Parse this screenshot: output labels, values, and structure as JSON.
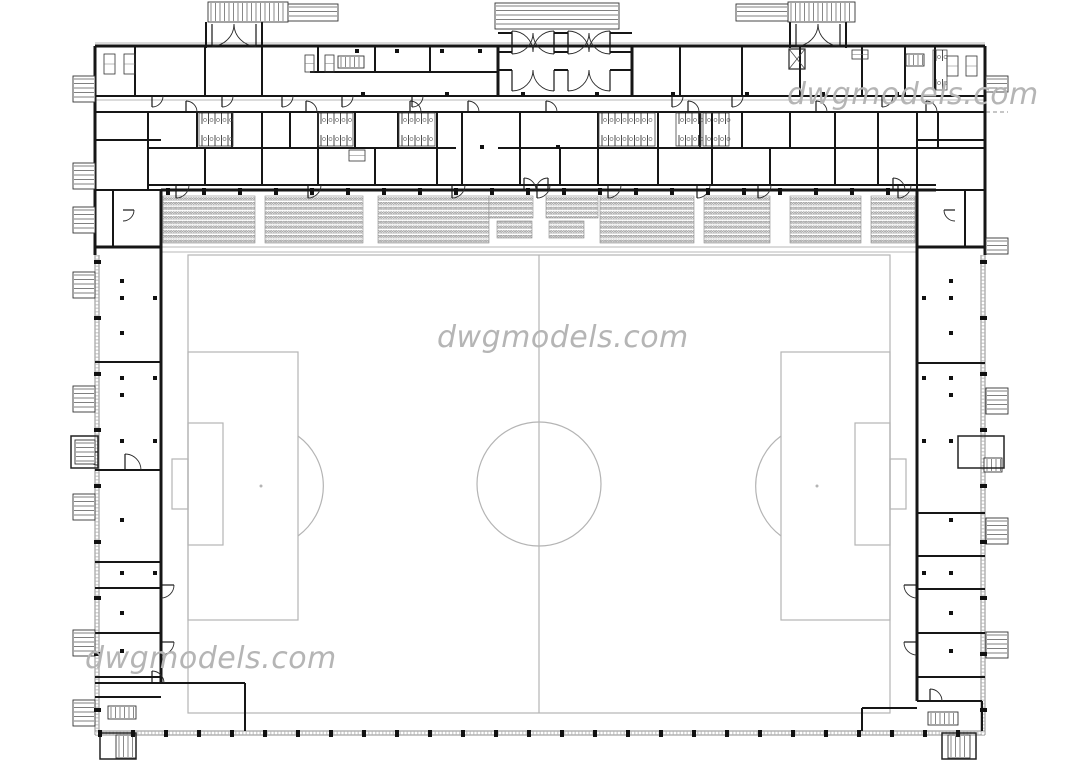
{
  "watermark": {
    "text": "dwgmodels.com",
    "color": "#b5b5b5"
  },
  "plan": {
    "colors": {
      "wall": "#161616",
      "field": "#b4b4b4",
      "light": "#b7b7b7",
      "hatch": "#8c8c8c",
      "seat": "#6f6f6f"
    },
    "canvas": {
      "w": 1080,
      "h": 760
    },
    "field": {
      "boundary": [
        188,
        255,
        702,
        458
      ],
      "center_line_x": 539,
      "center_circle": [
        539,
        484,
        62
      ],
      "penalty_spots": [
        [
          261,
          486
        ],
        [
          817,
          486
        ]
      ],
      "left_penalty_box": [
        188,
        352,
        110,
        268
      ],
      "left_goal_area": [
        188,
        423,
        35,
        122
      ],
      "right_penalty_box": [
        781,
        352,
        109,
        268
      ],
      "right_goal_area": [
        855,
        423,
        35,
        122
      ],
      "left_arc": "M298,436 A62,62 0 0 1 298,536",
      "right_arc": "M781,436 A62,62 0 0 0 781,536",
      "goals": [
        [
          172,
          459,
          16,
          50
        ],
        [
          890,
          459,
          16,
          50
        ]
      ]
    },
    "walls3": [
      [
        95,
        46,
        985,
        46
      ],
      [
        95,
        46,
        95,
        255
      ],
      [
        985,
        46,
        985,
        255
      ],
      [
        161,
        190,
        936,
        190
      ],
      [
        161,
        190,
        161,
        683
      ],
      [
        917,
        190,
        917,
        701
      ],
      [
        95,
        247,
        161,
        247
      ],
      [
        917,
        247,
        985,
        247
      ],
      [
        498,
        45,
        498,
        96
      ],
      [
        632,
        45,
        632,
        96
      ]
    ],
    "walls2": [
      [
        95,
        96,
        985,
        96
      ],
      [
        95,
        112,
        985,
        112
      ],
      [
        148,
        148,
        456,
        148
      ],
      [
        498,
        148,
        985,
        148
      ],
      [
        148,
        185,
        936,
        185
      ],
      [
        95,
        140,
        161,
        140
      ],
      [
        917,
        140,
        985,
        140
      ],
      [
        310,
        72,
        498,
        72
      ],
      [
        95,
        190,
        161,
        190
      ],
      [
        936,
        190,
        985,
        190
      ],
      [
        135,
        45,
        135,
        96
      ],
      [
        205,
        45,
        205,
        96
      ],
      [
        262,
        45,
        262,
        96
      ],
      [
        318,
        45,
        318,
        72
      ],
      [
        375,
        45,
        375,
        72
      ],
      [
        430,
        45,
        430,
        72
      ],
      [
        680,
        45,
        680,
        96
      ],
      [
        742,
        45,
        742,
        96
      ],
      [
        800,
        45,
        800,
        96
      ],
      [
        862,
        45,
        862,
        96
      ],
      [
        905,
        45,
        905,
        96
      ],
      [
        935,
        45,
        935,
        96
      ],
      [
        148,
        112,
        148,
        190
      ],
      [
        197,
        112,
        197,
        148
      ],
      [
        232,
        112,
        232,
        148
      ],
      [
        262,
        112,
        262,
        148
      ],
      [
        290,
        112,
        290,
        148
      ],
      [
        318,
        112,
        318,
        148
      ],
      [
        355,
        112,
        355,
        148
      ],
      [
        398,
        112,
        398,
        148
      ],
      [
        437,
        112,
        437,
        148
      ],
      [
        462,
        112,
        462,
        148
      ],
      [
        520,
        112,
        520,
        148
      ],
      [
        598,
        112,
        598,
        148
      ],
      [
        658,
        112,
        658,
        148
      ],
      [
        700,
        112,
        700,
        148
      ],
      [
        712,
        112,
        712,
        148
      ],
      [
        742,
        112,
        742,
        148
      ],
      [
        790,
        112,
        790,
        148
      ],
      [
        835,
        112,
        835,
        148
      ],
      [
        878,
        112,
        878,
        148
      ],
      [
        917,
        112,
        917,
        190
      ],
      [
        938,
        112,
        938,
        148
      ],
      [
        205,
        148,
        205,
        185
      ],
      [
        262,
        148,
        262,
        185
      ],
      [
        318,
        148,
        318,
        185
      ],
      [
        375,
        148,
        375,
        185
      ],
      [
        437,
        148,
        437,
        185
      ],
      [
        462,
        148,
        462,
        185
      ],
      [
        520,
        148,
        520,
        185
      ],
      [
        560,
        148,
        560,
        185
      ],
      [
        598,
        148,
        598,
        185
      ],
      [
        658,
        148,
        658,
        185
      ],
      [
        712,
        148,
        712,
        185
      ],
      [
        770,
        148,
        770,
        185
      ],
      [
        835,
        148,
        835,
        185
      ],
      [
        878,
        148,
        878,
        185
      ],
      [
        95,
        362,
        161,
        362
      ],
      [
        95,
        470,
        161,
        470
      ],
      [
        95,
        562,
        161,
        562
      ],
      [
        95,
        588,
        161,
        588
      ],
      [
        95,
        633,
        161,
        633
      ],
      [
        95,
        677,
        161,
        677
      ],
      [
        95,
        697,
        161,
        697
      ],
      [
        95,
        683,
        245,
        683
      ],
      [
        245,
        683,
        245,
        731
      ],
      [
        917,
        363,
        985,
        363
      ],
      [
        917,
        513,
        985,
        513
      ],
      [
        917,
        556,
        985,
        556
      ],
      [
        917,
        589,
        985,
        589
      ],
      [
        917,
        633,
        985,
        633
      ],
      [
        917,
        677,
        985,
        677
      ],
      [
        917,
        701,
        982,
        701
      ],
      [
        982,
        701,
        982,
        731
      ],
      [
        862,
        708,
        917,
        708
      ],
      [
        862,
        708,
        862,
        731
      ],
      [
        113,
        190,
        113,
        247
      ],
      [
        965,
        190,
        965,
        247
      ],
      [
        498,
        33,
        512,
        33
      ],
      [
        554,
        33,
        568,
        33
      ],
      [
        610,
        33,
        632,
        33
      ],
      [
        498,
        52,
        512,
        52
      ],
      [
        554,
        52,
        568,
        52
      ],
      [
        610,
        52,
        632,
        52
      ],
      [
        498,
        70,
        512,
        70
      ],
      [
        554,
        70,
        568,
        70
      ],
      [
        610,
        70,
        632,
        70
      ],
      [
        206,
        22,
        206,
        48
      ],
      [
        262,
        22,
        262,
        48
      ],
      [
        790,
        22,
        790,
        48
      ],
      [
        846,
        22,
        846,
        48
      ]
    ],
    "light_lines": [
      [
        95,
        43,
        985,
        43
      ],
      [
        95,
        100,
        985,
        100
      ],
      [
        161,
        247,
        917,
        247
      ],
      [
        161,
        252,
        917,
        252
      ]
    ],
    "dashed_lines": [
      [
        790,
        112,
        1008,
        112
      ]
    ],
    "hatch_walls": [
      [
        95,
        255,
        95,
        735
      ],
      [
        99,
        255,
        99,
        735
      ],
      [
        981,
        255,
        981,
        735
      ],
      [
        985,
        255,
        985,
        735
      ],
      [
        95,
        731,
        985,
        731
      ],
      [
        95,
        735,
        985,
        735
      ]
    ],
    "doors": [
      [
        176,
        185,
        13,
        90,
        0
      ],
      [
        308,
        185,
        13,
        90,
        0
      ],
      [
        452,
        185,
        13,
        90,
        0
      ],
      [
        537,
        185,
        13,
        90,
        0
      ],
      [
        608,
        185,
        13,
        90,
        0
      ],
      [
        697,
        185,
        13,
        90,
        0
      ],
      [
        758,
        185,
        13,
        90,
        0
      ],
      [
        898,
        185,
        13,
        90,
        0
      ],
      [
        186,
        112,
        11,
        270,
        360
      ],
      [
        306,
        112,
        11,
        270,
        360
      ],
      [
        410,
        112,
        11,
        270,
        360
      ],
      [
        468,
        112,
        11,
        270,
        360
      ],
      [
        546,
        112,
        11,
        270,
        360
      ],
      [
        688,
        112,
        11,
        270,
        360
      ],
      [
        816,
        112,
        11,
        270,
        360
      ],
      [
        926,
        112,
        11,
        270,
        360
      ],
      [
        152,
        96,
        11,
        90,
        0
      ],
      [
        222,
        96,
        11,
        90,
        0
      ],
      [
        282,
        96,
        11,
        90,
        0
      ],
      [
        342,
        96,
        11,
        90,
        0
      ],
      [
        412,
        96,
        11,
        90,
        0
      ],
      [
        672,
        96,
        11,
        90,
        0
      ],
      [
        732,
        96,
        11,
        90,
        0
      ],
      [
        882,
        96,
        11,
        90,
        0
      ],
      [
        161,
        585,
        13,
        0,
        90
      ],
      [
        161,
        642,
        13,
        0,
        90
      ],
      [
        917,
        585,
        13,
        180,
        90
      ],
      [
        917,
        642,
        13,
        180,
        90
      ],
      [
        512,
        33,
        21,
        90,
        0
      ],
      [
        554,
        33,
        21,
        90,
        180
      ],
      [
        568,
        33,
        21,
        90,
        0
      ],
      [
        610,
        33,
        21,
        90,
        180
      ],
      [
        512,
        52,
        21,
        270,
        360
      ],
      [
        554,
        52,
        21,
        270,
        180
      ],
      [
        568,
        52,
        21,
        270,
        360
      ],
      [
        610,
        52,
        21,
        270,
        180
      ],
      [
        512,
        70,
        21,
        90,
        0
      ],
      [
        554,
        70,
        21,
        90,
        180
      ],
      [
        568,
        70,
        21,
        90,
        0
      ],
      [
        610,
        70,
        21,
        90,
        180
      ],
      [
        212,
        24,
        22,
        90,
        0
      ],
      [
        256,
        24,
        22,
        90,
        180
      ],
      [
        796,
        24,
        22,
        90,
        0
      ],
      [
        840,
        24,
        22,
        90,
        180
      ],
      [
        98,
        452,
        13,
        180,
        90
      ],
      [
        125,
        470,
        16,
        270,
        360
      ],
      [
        152,
        683,
        12,
        270,
        360
      ],
      [
        930,
        701,
        12,
        270,
        360
      ],
      [
        123,
        210,
        11,
        0,
        90
      ],
      [
        955,
        210,
        11,
        180,
        90
      ],
      [
        524,
        190,
        12,
        270,
        360
      ],
      [
        548,
        190,
        12,
        270,
        180
      ],
      [
        893,
        190,
        12,
        270,
        360
      ]
    ],
    "stairs": [
      [
        208,
        2,
        80,
        20,
        "v"
      ],
      [
        495,
        3,
        124,
        26,
        "h"
      ],
      [
        788,
        2,
        67,
        20,
        "v"
      ],
      [
        288,
        4,
        50,
        17,
        "h"
      ],
      [
        736,
        4,
        52,
        17,
        "h"
      ],
      [
        73,
        76,
        22,
        26,
        "h"
      ],
      [
        73,
        163,
        22,
        26,
        "h"
      ],
      [
        73,
        207,
        22,
        26,
        "h"
      ],
      [
        73,
        272,
        22,
        26,
        "h"
      ],
      [
        73,
        386,
        22,
        26,
        "h"
      ],
      [
        75,
        440,
        20,
        24,
        "h"
      ],
      [
        73,
        494,
        22,
        26,
        "h"
      ],
      [
        73,
        630,
        22,
        26,
        "h"
      ],
      [
        73,
        700,
        22,
        26,
        "h"
      ],
      [
        986,
        76,
        22,
        16,
        "h"
      ],
      [
        986,
        238,
        22,
        16,
        "h"
      ],
      [
        986,
        388,
        22,
        26,
        "h"
      ],
      [
        986,
        518,
        22,
        26,
        "h"
      ],
      [
        986,
        632,
        22,
        26,
        "h"
      ],
      [
        984,
        458,
        18,
        14,
        "v"
      ],
      [
        108,
        706,
        28,
        13,
        "v"
      ],
      [
        338,
        56,
        26,
        12,
        "v"
      ],
      [
        906,
        54,
        18,
        12,
        "v"
      ],
      [
        928,
        712,
        30,
        13,
        "v"
      ],
      [
        116,
        735,
        20,
        23,
        "v"
      ],
      [
        948,
        735,
        22,
        23,
        "v"
      ]
    ],
    "blocks": [
      [
        71,
        436,
        27,
        32
      ],
      [
        958,
        436,
        46,
        32
      ],
      [
        100,
        733,
        36,
        26
      ],
      [
        942,
        733,
        34,
        26
      ]
    ],
    "combs": [
      [
        199,
        113,
        34,
        33
      ],
      [
        318,
        113,
        35,
        33
      ],
      [
        399,
        113,
        36,
        33
      ],
      [
        599,
        113,
        56,
        33
      ],
      [
        676,
        113,
        25,
        33
      ],
      [
        703,
        113,
        26,
        33
      ],
      [
        933,
        50,
        14,
        40
      ]
    ],
    "equip": [
      [
        104,
        54,
        11,
        20
      ],
      [
        124,
        54,
        11,
        20
      ],
      [
        947,
        56,
        11,
        20
      ],
      [
        966,
        56,
        11,
        20
      ],
      [
        305,
        55,
        9,
        17
      ],
      [
        325,
        55,
        9,
        17
      ],
      [
        852,
        50,
        16,
        9
      ],
      [
        349,
        150,
        16,
        11
      ]
    ],
    "elevator": [
      789,
      49,
      16,
      20
    ],
    "dots": [
      [
        357,
        51
      ],
      [
        397,
        51
      ],
      [
        442,
        51
      ],
      [
        480,
        51
      ],
      [
        363,
        94
      ],
      [
        447,
        94
      ],
      [
        523,
        94
      ],
      [
        597,
        94
      ],
      [
        673,
        94
      ],
      [
        747,
        94
      ],
      [
        823,
        94
      ],
      [
        897,
        94
      ],
      [
        482,
        147
      ],
      [
        558,
        147
      ],
      [
        122,
        281
      ],
      [
        122,
        298
      ],
      [
        122,
        333
      ],
      [
        122,
        378
      ],
      [
        122,
        395
      ],
      [
        122,
        441
      ],
      [
        122,
        520
      ],
      [
        122,
        573
      ],
      [
        122,
        613
      ],
      [
        122,
        651
      ],
      [
        155,
        298
      ],
      [
        155,
        378
      ],
      [
        155,
        441
      ],
      [
        155,
        573
      ],
      [
        951,
        281
      ],
      [
        951,
        298
      ],
      [
        951,
        333
      ],
      [
        951,
        378
      ],
      [
        951,
        395
      ],
      [
        951,
        441
      ],
      [
        951,
        520
      ],
      [
        951,
        573
      ],
      [
        951,
        613
      ],
      [
        951,
        651
      ],
      [
        924,
        298
      ],
      [
        924,
        378
      ],
      [
        924,
        441
      ],
      [
        924,
        573
      ]
    ],
    "seat_blocks": [
      [
        163,
        196,
        92,
        47
      ],
      [
        265,
        196,
        98,
        47
      ],
      [
        378,
        196,
        111,
        47
      ],
      [
        489,
        196,
        44,
        22
      ],
      [
        546,
        196,
        52,
        22
      ],
      [
        600,
        196,
        94,
        47
      ],
      [
        704,
        196,
        66,
        47
      ],
      [
        790,
        196,
        71,
        47
      ],
      [
        871,
        196,
        44,
        47
      ],
      [
        497,
        221,
        35,
        17
      ],
      [
        549,
        221,
        35,
        17
      ]
    ],
    "tick_rows": [
      {
        "axis": "x",
        "fixed": 191,
        "from": 168,
        "to": 912,
        "step": 36
      },
      {
        "axis": "x",
        "fixed": 733,
        "from": 100,
        "to": 976,
        "step": 33
      },
      {
        "axis": "y",
        "fixed": 97,
        "from": 262,
        "to": 720,
        "step": 56
      },
      {
        "axis": "y",
        "fixed": 983,
        "from": 262,
        "to": 720,
        "step": 56
      }
    ]
  }
}
